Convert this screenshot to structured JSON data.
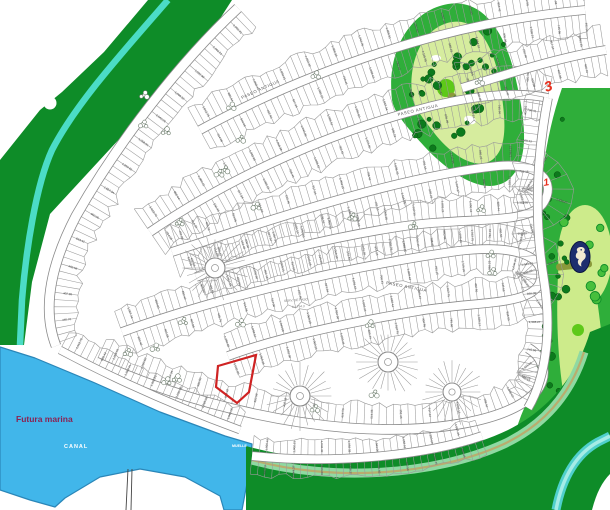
{
  "title": "Resort community master plan with golf course, marina and highlighted lot",
  "labels": {
    "futura_marina": "Futura marina",
    "canal": "CANAL",
    "muelle": "MUELLE",
    "street_name": "PASEO ANTIGUA",
    "easement_line1": "SERV. DE PASO",
    "easement_line2": "A= 794.3",
    "hole_front": "3",
    "hole_back": "1"
  },
  "icons": {
    "seahorse": "seahorse-icon"
  },
  "highlight": {
    "description": "selected-lot-outline",
    "color": "#cf2323"
  },
  "lot_numbers": [
    "1,060.41",
    "1,002.21",
    "1,032.30",
    "1,068.38",
    "1,043.06",
    "1,058.51",
    "1,250.60",
    "1,057.34",
    "900.00",
    "853.42",
    "402.58",
    "402.98",
    "465.76",
    "614.06",
    "514.06",
    "152.46",
    "917.34",
    "1,093.15",
    "708.41",
    "1,008.43",
    "782.15",
    "1,115.95",
    "960.23",
    "1,044.37",
    "836.09",
    "1,338.27",
    "745.66",
    "402.56",
    "1,012.75",
    "880.44"
  ],
  "colors": {
    "background": "#ffffff",
    "forest": "#0e8c28",
    "stripe": "#4bdcc6",
    "marina": "#41b6ea",
    "marina_edge": "#2a86b8",
    "rough": "#2fae3a",
    "fairway": "#d6ec9e",
    "fairway2": "#cdeb8b",
    "green_circle": "#5ec919",
    "olive": "#8a9a3a",
    "tree": "#0c7a1c",
    "tree_stroke": "#07510f",
    "swirl_tree": "#46bf3c",
    "band_stripe": "#8fd9a2",
    "band_path": "#b9ad6e",
    "river": "#4fd0cc",
    "river_core": "#a5ece6",
    "road_casing": "#8a8a8a",
    "lot_line": "#9a9a9a",
    "bush_stroke": "#6b7b6b",
    "highlight": "#cf2323",
    "hole_label": "#e8301e",
    "seahorse_bg": "#1d2e6e",
    "seahorse_fg": "#f2ead2",
    "pier": "#444444"
  }
}
